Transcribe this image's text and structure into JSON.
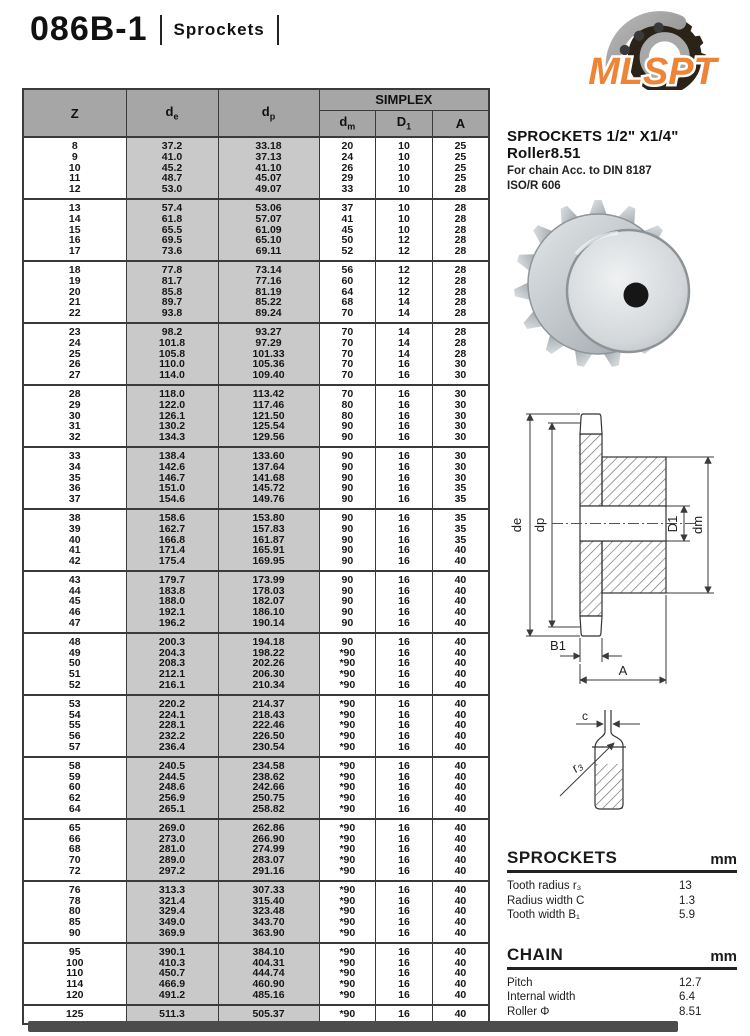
{
  "page": {
    "title": "086B-1",
    "subtitle": "Sprockets"
  },
  "logo": {
    "text": "MLSPT",
    "color": "#EE8435"
  },
  "product": {
    "heading": "SPROCKETS 1/2\" X1/4\" Roller8.51",
    "line1": "For chain Acc. to DIN 8187",
    "line2": "ISO/R 606"
  },
  "table": {
    "headers": {
      "z": "Z",
      "de": {
        "base": "d",
        "sub": "e"
      },
      "dp": {
        "base": "d",
        "sub": "p"
      },
      "simplex": "SIMPLEX",
      "dm": {
        "base": "d",
        "sub": "m"
      },
      "d1": {
        "base": "D",
        "sub": "1"
      },
      "a": "A"
    },
    "groups": [
      [
        [
          "8",
          "37.2",
          "33.18",
          "20",
          "10",
          "25"
        ],
        [
          "9",
          "41.0",
          "37.13",
          "24",
          "10",
          "25"
        ],
        [
          "10",
          "45.2",
          "41.10",
          "26",
          "10",
          "25"
        ],
        [
          "11",
          "48.7",
          "45.07",
          "29",
          "10",
          "25"
        ],
        [
          "12",
          "53.0",
          "49.07",
          "33",
          "10",
          "28"
        ]
      ],
      [
        [
          "13",
          "57.4",
          "53.06",
          "37",
          "10",
          "28"
        ],
        [
          "14",
          "61.8",
          "57.07",
          "41",
          "10",
          "28"
        ],
        [
          "15",
          "65.5",
          "61.09",
          "45",
          "10",
          "28"
        ],
        [
          "16",
          "69.5",
          "65.10",
          "50",
          "12",
          "28"
        ],
        [
          "17",
          "73.6",
          "69.11",
          "52",
          "12",
          "28"
        ]
      ],
      [
        [
          "18",
          "77.8",
          "73.14",
          "56",
          "12",
          "28"
        ],
        [
          "19",
          "81.7",
          "77.16",
          "60",
          "12",
          "28"
        ],
        [
          "20",
          "85.8",
          "81.19",
          "64",
          "12",
          "28"
        ],
        [
          "21",
          "89.7",
          "85.22",
          "68",
          "14",
          "28"
        ],
        [
          "22",
          "93.8",
          "89.24",
          "70",
          "14",
          "28"
        ]
      ],
      [
        [
          "23",
          "98.2",
          "93.27",
          "70",
          "14",
          "28"
        ],
        [
          "24",
          "101.8",
          "97.29",
          "70",
          "14",
          "28"
        ],
        [
          "25",
          "105.8",
          "101.33",
          "70",
          "14",
          "28"
        ],
        [
          "26",
          "110.0",
          "105.36",
          "70",
          "16",
          "30"
        ],
        [
          "27",
          "114.0",
          "109.40",
          "70",
          "16",
          "30"
        ]
      ],
      [
        [
          "28",
          "118.0",
          "113.42",
          "70",
          "16",
          "30"
        ],
        [
          "29",
          "122.0",
          "117.46",
          "80",
          "16",
          "30"
        ],
        [
          "30",
          "126.1",
          "121.50",
          "80",
          "16",
          "30"
        ],
        [
          "31",
          "130.2",
          "125.54",
          "90",
          "16",
          "30"
        ],
        [
          "32",
          "134.3",
          "129.56",
          "90",
          "16",
          "30"
        ]
      ],
      [
        [
          "33",
          "138.4",
          "133.60",
          "90",
          "16",
          "30"
        ],
        [
          "34",
          "142.6",
          "137.64",
          "90",
          "16",
          "30"
        ],
        [
          "35",
          "146.7",
          "141.68",
          "90",
          "16",
          "30"
        ],
        [
          "36",
          "151.0",
          "145.72",
          "90",
          "16",
          "35"
        ],
        [
          "37",
          "154.6",
          "149.76",
          "90",
          "16",
          "35"
        ]
      ],
      [
        [
          "38",
          "158.6",
          "153.80",
          "90",
          "16",
          "35"
        ],
        [
          "39",
          "162.7",
          "157.83",
          "90",
          "16",
          "35"
        ],
        [
          "40",
          "166.8",
          "161.87",
          "90",
          "16",
          "35"
        ],
        [
          "41",
          "171.4",
          "165.91",
          "90",
          "16",
          "40"
        ],
        [
          "42",
          "175.4",
          "169.95",
          "90",
          "16",
          "40"
        ]
      ],
      [
        [
          "43",
          "179.7",
          "173.99",
          "90",
          "16",
          "40"
        ],
        [
          "44",
          "183.8",
          "178.03",
          "90",
          "16",
          "40"
        ],
        [
          "45",
          "188.0",
          "182.07",
          "90",
          "16",
          "40"
        ],
        [
          "46",
          "192.1",
          "186.10",
          "90",
          "16",
          "40"
        ],
        [
          "47",
          "196.2",
          "190.14",
          "90",
          "16",
          "40"
        ]
      ],
      [
        [
          "48",
          "200.3",
          "194.18",
          "90",
          "16",
          "40"
        ],
        [
          "49",
          "204.3",
          "198.22",
          "*90",
          "16",
          "40"
        ],
        [
          "50",
          "208.3",
          "202.26",
          "*90",
          "16",
          "40"
        ],
        [
          "51",
          "212.1",
          "206.30",
          "*90",
          "16",
          "40"
        ],
        [
          "52",
          "216.1",
          "210.34",
          "*90",
          "16",
          "40"
        ]
      ],
      [
        [
          "53",
          "220.2",
          "214.37",
          "*90",
          "16",
          "40"
        ],
        [
          "54",
          "224.1",
          "218.43",
          "*90",
          "16",
          "40"
        ],
        [
          "55",
          "228.1",
          "222.46",
          "*90",
          "16",
          "40"
        ],
        [
          "56",
          "232.2",
          "226.50",
          "*90",
          "16",
          "40"
        ],
        [
          "57",
          "236.4",
          "230.54",
          "*90",
          "16",
          "40"
        ]
      ],
      [
        [
          "58",
          "240.5",
          "234.58",
          "*90",
          "16",
          "40"
        ],
        [
          "59",
          "244.5",
          "238.62",
          "*90",
          "16",
          "40"
        ],
        [
          "60",
          "248.6",
          "242.66",
          "*90",
          "16",
          "40"
        ],
        [
          "62",
          "256.9",
          "250.75",
          "*90",
          "16",
          "40"
        ],
        [
          "64",
          "265.1",
          "258.82",
          "*90",
          "16",
          "40"
        ]
      ],
      [
        [
          "65",
          "269.0",
          "262.86",
          "*90",
          "16",
          "40"
        ],
        [
          "66",
          "273.0",
          "266.90",
          "*90",
          "16",
          "40"
        ],
        [
          "68",
          "281.0",
          "274.99",
          "*90",
          "16",
          "40"
        ],
        [
          "70",
          "289.0",
          "283.07",
          "*90",
          "16",
          "40"
        ],
        [
          "72",
          "297.2",
          "291.16",
          "*90",
          "16",
          "40"
        ]
      ],
      [
        [
          "76",
          "313.3",
          "307.33",
          "*90",
          "16",
          "40"
        ],
        [
          "78",
          "321.4",
          "315.40",
          "*90",
          "16",
          "40"
        ],
        [
          "80",
          "329.4",
          "323.48",
          "*90",
          "16",
          "40"
        ],
        [
          "85",
          "349.0",
          "343.70",
          "*90",
          "16",
          "40"
        ],
        [
          "90",
          "369.9",
          "363.90",
          "*90",
          "16",
          "40"
        ]
      ],
      [
        [
          "95",
          "390.1",
          "384.10",
          "*90",
          "16",
          "40"
        ],
        [
          "100",
          "410.3",
          "404.31",
          "*90",
          "16",
          "40"
        ],
        [
          "110",
          "450.7",
          "444.74",
          "*90",
          "16",
          "40"
        ],
        [
          "114",
          "466.9",
          "460.90",
          "*90",
          "16",
          "40"
        ],
        [
          "120",
          "491.2",
          "485.16",
          "*90",
          "16",
          "40"
        ]
      ],
      [
        [
          "125",
          "511.3",
          "505.37",
          "*90",
          "16",
          "40"
        ]
      ]
    ]
  },
  "diagram": {
    "labels": {
      "de": "de",
      "dp": "dp",
      "d1": "D1",
      "dm": "dm",
      "b1": "B1",
      "a": "A",
      "c": "c",
      "r3": "r₃"
    }
  },
  "specs": {
    "sprockets": {
      "title": "SPROCKETS",
      "unit": "mm",
      "rows": [
        {
          "label": "Tooth radius r₃",
          "value": "13"
        },
        {
          "label": "Radius width C",
          "value": "1.3"
        },
        {
          "label": "Tooth width B₁",
          "value": "5.9"
        }
      ]
    },
    "chain": {
      "title": "CHAIN",
      "unit": "mm",
      "rows": [
        {
          "label": "Pitch",
          "value": "12.7"
        },
        {
          "label": "Internal width",
          "value": "6.4"
        },
        {
          "label": "Roller Φ",
          "value": "8.51"
        }
      ]
    },
    "notes": [
      "Material: C 45",
      "*Weld on hub"
    ]
  }
}
